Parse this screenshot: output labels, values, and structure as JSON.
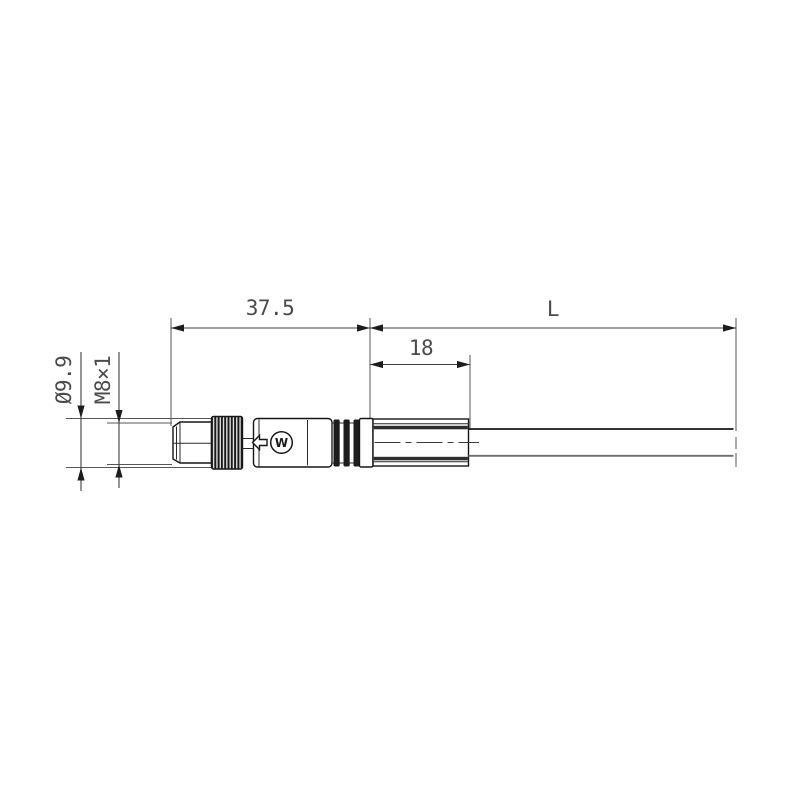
{
  "page": {
    "background": "#ffffff"
  },
  "diagram": {
    "type": "technical-drawing",
    "subject": "M8 male straight connector with molded body and cable, side view",
    "units": "mm",
    "colors": {
      "outline": "#161616",
      "dimension_line": "#3f3f3f",
      "dimension_text": "#4a4a4a",
      "knurl_dark": "#1a1a1a",
      "band_dark": "#2e2e2e",
      "cable_shadow_edge": "#6e6e6e",
      "background": "#ffffff"
    },
    "labels": {
      "connector_length": "37.5",
      "cable_length": "L",
      "boot_length": "18",
      "outer_diameter": "Ø9.9",
      "thread_size": "M8×1",
      "logo_mark": "W"
    }
  }
}
